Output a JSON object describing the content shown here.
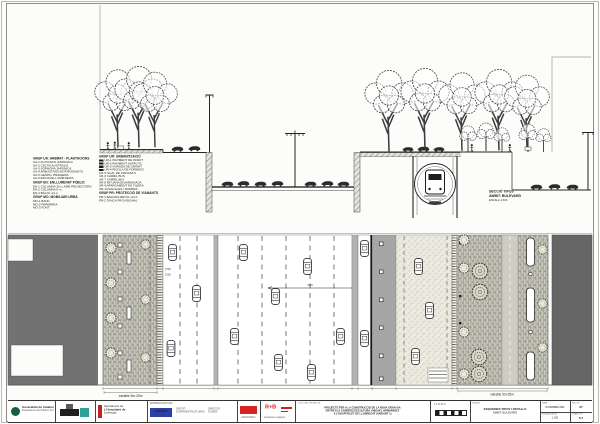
{
  "colors": {
    "accent_red": "#d41f1f",
    "accent_blue": "#2a3fa8",
    "accent_green": "#14603a",
    "accent_teal": "#2fa39b"
  },
  "section": {
    "label_l1": "SECCIÓ TIPUS",
    "label_l2": "ÀMBIT: BULEVARD",
    "label_l3": "ESCALA 1:300"
  },
  "legend": {
    "ua": {
      "title": "GRUP UA: ARBRAT - PLANTACIONS",
      "items": [
        "UA-1  PLATANUS HISPANICA",
        "UA-2  CELTIS AUSTRALIS",
        "UA-3  SOPHORA JAPONICA",
        "UA-4  ARBUSTIVES ENTAPISSANTS",
        "UA-5  GESPA I PRADERIA",
        "UA-6  ESCOCELL AMB REIXA"
      ]
    },
    "en": {
      "title": "GRUP EN: ENLLUMENAT PÚBLIC",
      "items": [
        "EN-1  COLUMNA 25 m AMB PROJECTORS",
        "EN-2  COLUMNA 9 m",
        "EN-3  BÀCUL 12 m"
      ]
    },
    "mo": {
      "title": "GRUP MO: MOBILIARI URBÀ",
      "items": [
        "MO-1  BANC",
        "MO-2  PAPERERA",
        "MO-3  FONT"
      ]
    },
    "ur": {
      "title": "GRUP UR: URBANITZACIÓ",
      "items": [
        "UR-1  PAVIMENT DE PANOT",
        "UR-2  PAVIMENT ASFÀLTIC",
        "UR-3  VORADA DE GRANIT",
        "UR-4  RIGOLA DE FORMIGÓ",
        "UR-5  GUAL DE VIANANTS",
        "UR-6  CARRIL BUS",
        "UR-7  CARRIL BICI",
        "UR-8  MITJANA ENJARDINADA",
        "UR-9  APARCAMENT EN FILERA",
        "UR-10 ESCALES I RAMPES"
      ]
    },
    "pr": {
      "title": "GRUP PR: PROTECCIÓ DE VIANANTS",
      "items": [
        "PR-1  BARANA METÀL·LICA",
        "PR-2  TANCA PROVISIONAL"
      ]
    }
  },
  "plan": {
    "dim_left": "variable 5m-25m",
    "dim_right": "variable 5m-25m",
    "lane_dims": [
      "3.50",
      "3.50",
      "3.50"
    ]
  },
  "titleblock": {
    "gencat_l1": "Generalitat de Catalunya",
    "gencat_l2": "Departament de Política Territorial",
    "ajuntament_l1": "Ajuntament de",
    "ajuntament_l2": "L'Hospitalet de",
    "ajuntament_l3": "Llobregat",
    "gestor_header": "EMPRESA GESTORA",
    "gestor_name": "EGECSA",
    "gestor_a1": "GESTIÓ",
    "gestor_a2": "D'INFRAESTRUCTURES",
    "gestor_b1": "DIRECCIÓ",
    "gestor_b2": "D'OBRA",
    "consultor_text": "ENGINYERIA",
    "rb_label": "R+B",
    "rb_text": "arquitectes enginyers",
    "title_header": "TÍTOL DEL PROJECTE",
    "project_title_l1": "PROJECTE PER A LA CONSTRUCCIÓ DE LA NOVA GRAN VIA",
    "project_title_l2": "ENTRE ELS CARRERS ESCULTURA I MIGUEL HERNÁNDEZ",
    "project_title_l3": "A L'HOSPITALET DE LLOBREGAT (VARIANT 1)",
    "scale_ticks": "0    5    10        25 m",
    "plan_header": "PLÀNOL",
    "plan_name_l1": "ESQUEMES TIPUS I DETALLS",
    "plan_name_l2": "ÀMBIT: BULEVARD",
    "date_label": "DATA",
    "date_value": "NOVEMBRE 2002",
    "scale_label": "ESCALA DIN-A1",
    "scale_value": "1:300",
    "sheet_label": "FULL Nº",
    "sheet_value": "07",
    "plan_num_label": "PLÀNOL Nº",
    "plan_num_value": "6.7"
  }
}
